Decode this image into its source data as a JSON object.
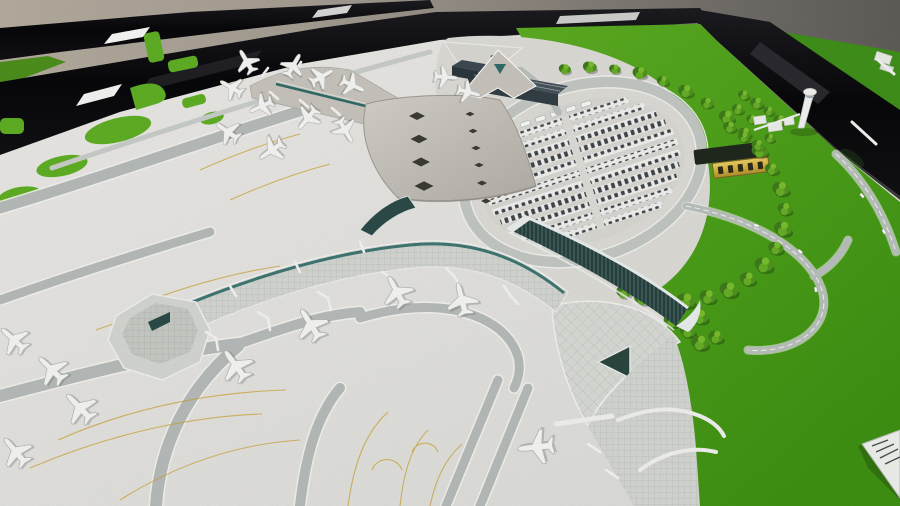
{
  "scene": {
    "type": "photograph",
    "subject": "architectural scale model of an airport terminal complex on a display table",
    "elements": [
      "star-shaped terminal with diamond skylights",
      "long curved concourse piers with teal glass stripes",
      "white model airplanes parked at gates",
      "gray taxiways with yellow guide lines",
      "oval landside loop with rows of parked cars",
      "semicircular tree-lined ring",
      "dark slab landside building",
      "slanted white control tower model",
      "gold nameplate plaque (characters not legible)",
      "glossy black display-table frames with reflections",
      "bright green felt groundcover",
      "gray studio wall",
      "white information card corner at right edge"
    ],
    "counts": {
      "visible_airplanes": 21,
      "parking_rows": 11,
      "plaque_glyph_blocks": 5
    }
  },
  "palette": {
    "wall_light": "#b3aa9e",
    "wall_dark": "#5f5c58",
    "frame_black": "#0a0a0d",
    "felt_left": "#4c8f1c",
    "felt_right": "#3f8f1a",
    "felt_main": "#55a81f",
    "base_light": "#e7e6e2",
    "taxiway": "#b6bbb9",
    "guide_yellow": "#c9a02f",
    "roof_warm": "#c8c4bd",
    "pier_roof": "#d4d6d2",
    "glass_teal": "#24403d",
    "accent_teal": "#2f6b66",
    "slab_dark": "#333e45",
    "tree_green": "#4f941f",
    "plane_white": "#f5f6f3",
    "plaque_gold": "#d9b944",
    "road_gray": "#b9c0bb",
    "tower_white": "#f2f3f1",
    "card_white": "#eef0ec"
  }
}
